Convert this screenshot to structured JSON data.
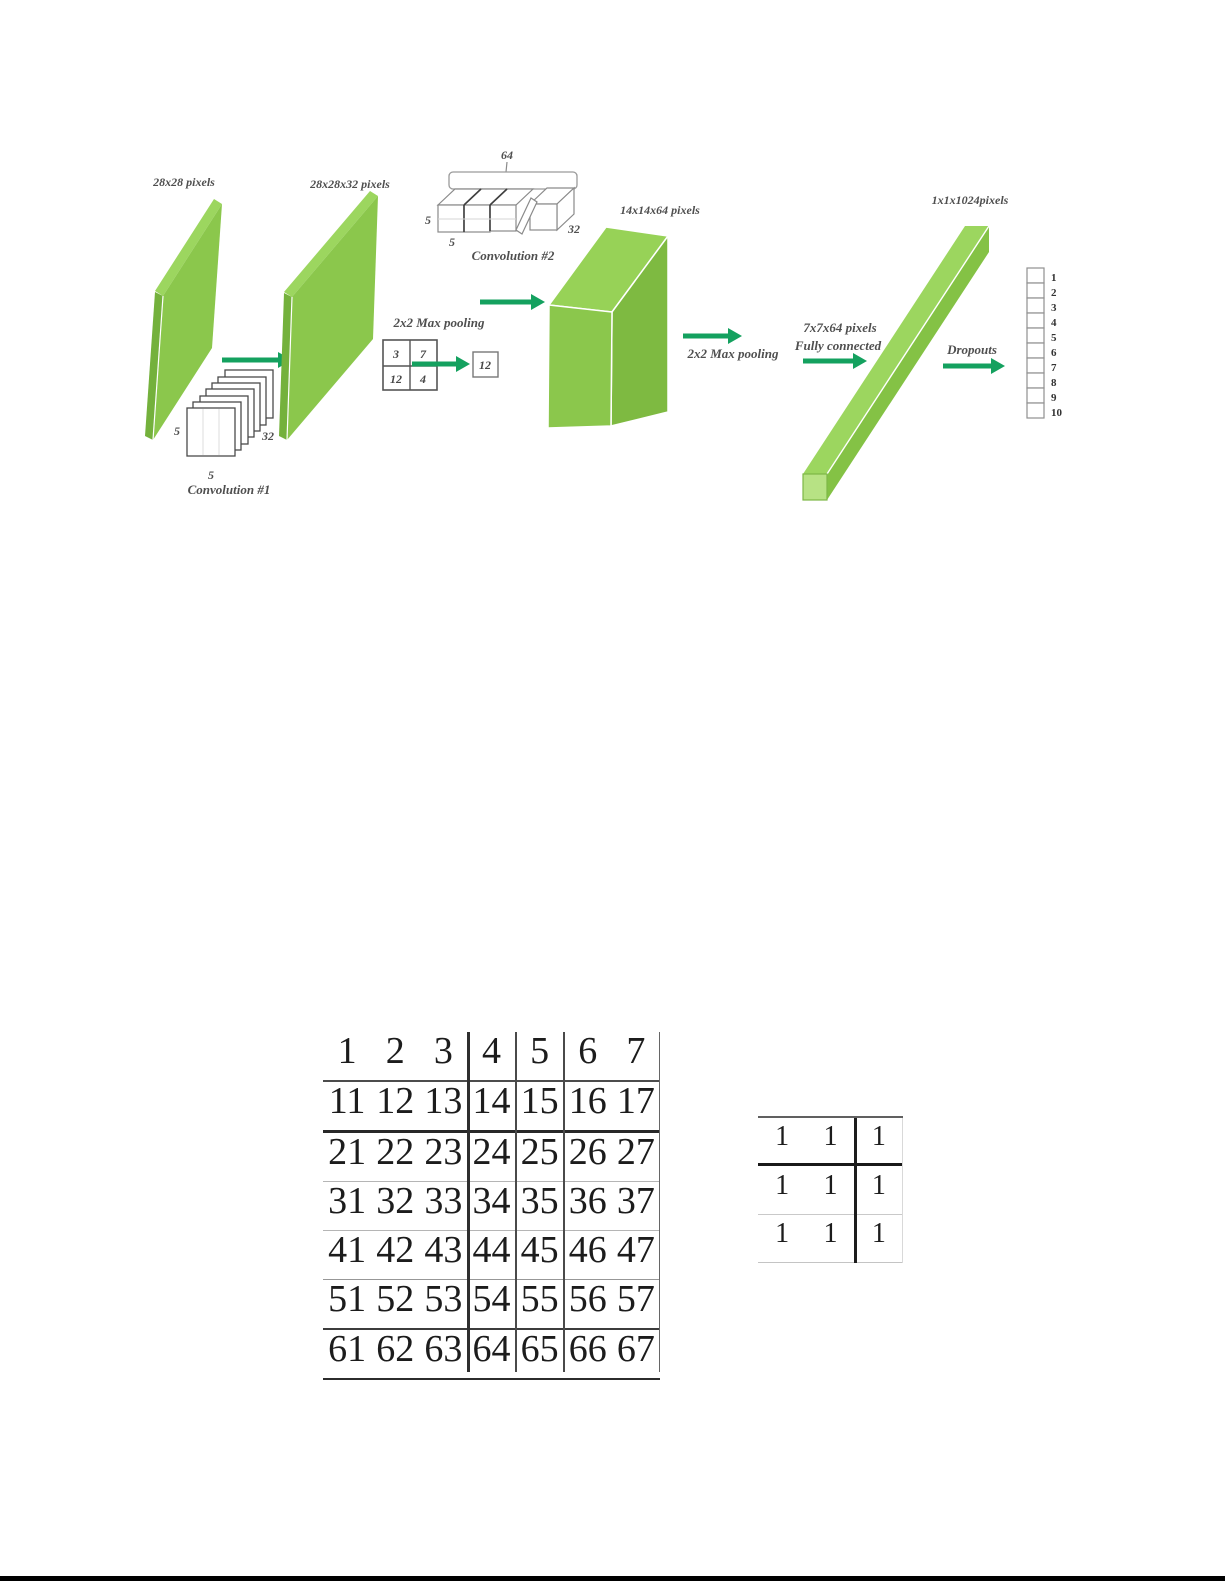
{
  "colors": {
    "slab_green": "#8bc74c",
    "slab_green_light": "#9cd65f",
    "slab_green_dark": "#7eba41",
    "bar_green_light": "#9cd65f",
    "bar_green": "#84c245",
    "bar_end_green": "#b7e284",
    "arrow_green": "#14a15f",
    "label_gray": "#4f4f4f"
  },
  "diagram": {
    "input_label": "28x28 pixels",
    "conv1": {
      "label": "Convolution #1",
      "k_h": "5",
      "k_w": "5",
      "depth": "32"
    },
    "layer2_label": "28x28x32 pixels",
    "conv2": {
      "label": "Convolution #2",
      "filters": "64",
      "k_h": "5",
      "k_w": "5",
      "depth": "32"
    },
    "pool1": {
      "label": "2x2 Max pooling",
      "cells": [
        "3",
        "7",
        "12",
        "4"
      ],
      "result": "12"
    },
    "layer3_label": "14x14x64 pixels",
    "pool2": {
      "label": "2x2 Max pooling"
    },
    "fc": {
      "line1": "7x7x64 pixels",
      "line2": "Fully connected"
    },
    "fc_layer_label": "1x1x1024pixels",
    "dropout_label": "Dropouts",
    "output_units": [
      "1",
      "2",
      "3",
      "4",
      "5",
      "6",
      "7",
      "8",
      "9",
      "10"
    ]
  },
  "matrix_table": {
    "rows": [
      [
        "1",
        "2",
        "3",
        "4",
        "5",
        "6",
        "7"
      ],
      [
        "11",
        "12",
        "13",
        "14",
        "15",
        "16",
        "17"
      ],
      [
        "21",
        "22",
        "23",
        "24",
        "25",
        "26",
        "27"
      ],
      [
        "31",
        "32",
        "33",
        "34",
        "35",
        "36",
        "37"
      ],
      [
        "41",
        "42",
        "43",
        "44",
        "45",
        "46",
        "47"
      ],
      [
        "51",
        "52",
        "53",
        "54",
        "55",
        "56",
        "57"
      ],
      [
        "61",
        "62",
        "63",
        "64",
        "65",
        "66",
        "67"
      ]
    ]
  },
  "kernel_table": {
    "rows": [
      [
        "1",
        "1",
        "1"
      ],
      [
        "1",
        "1",
        "1"
      ],
      [
        "1",
        "1",
        "1"
      ]
    ]
  }
}
